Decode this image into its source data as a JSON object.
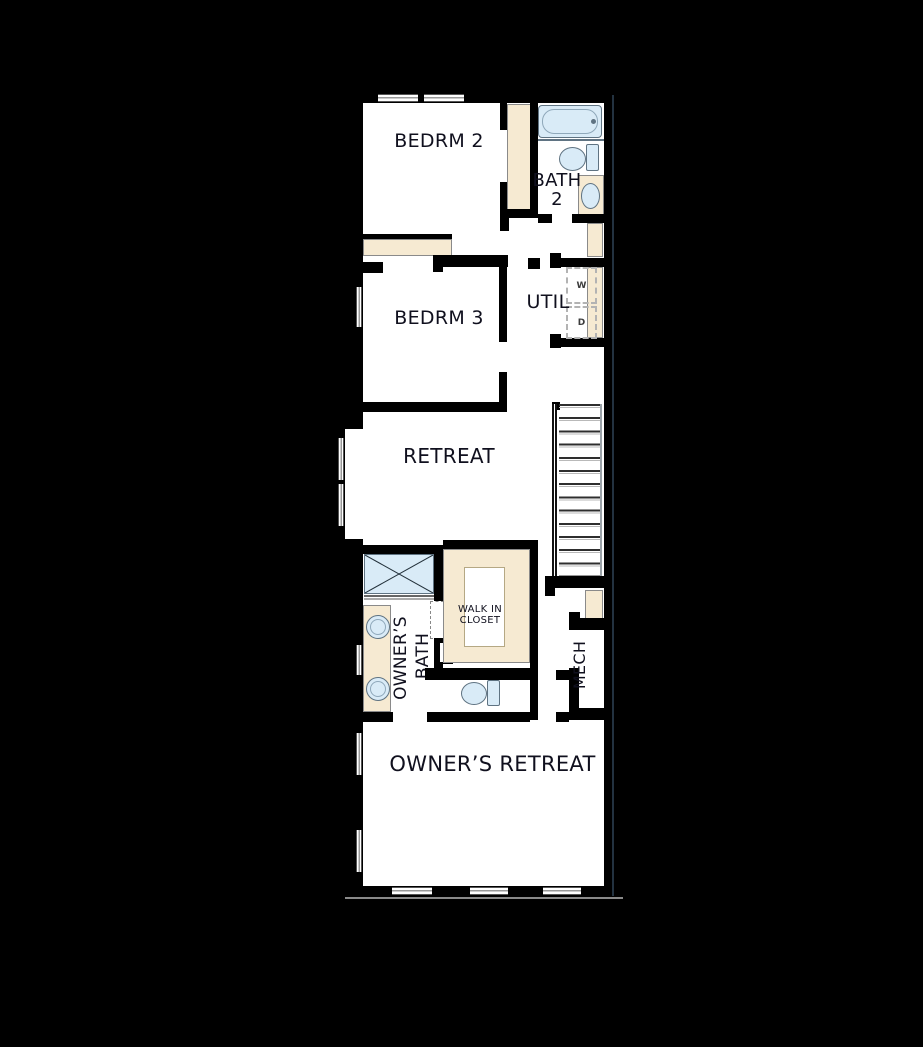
{
  "plan": {
    "rooms": {
      "bedrm2": {
        "label": "BEDRM 2"
      },
      "bath2": {
        "line1": "BATH",
        "line2": "2"
      },
      "bedrm3": {
        "label": "BEDRM 3"
      },
      "util": {
        "label": "UTIL"
      },
      "retreat": {
        "label": "RETREAT"
      },
      "walk_in_closet": {
        "line1": "WALK IN",
        "line2": "CLOSET"
      },
      "owners_bath": {
        "line1": "OWNER’S",
        "line2": "BATH"
      },
      "mech": {
        "label": "MECH"
      },
      "owners_retreat": {
        "label": "OWNER’S RETREAT"
      }
    },
    "appliances": {
      "washer": "W",
      "dryer": "D"
    },
    "colors": {
      "background": "#000000",
      "wall": "#000000",
      "floor": "#ffffff",
      "fixture-fill": "#d9ebf7",
      "fixture-stroke": "#5f7382",
      "casework-fill": "#f6ead2",
      "casework-stroke": "#8a8a8a",
      "label-text": "#10101e"
    }
  }
}
